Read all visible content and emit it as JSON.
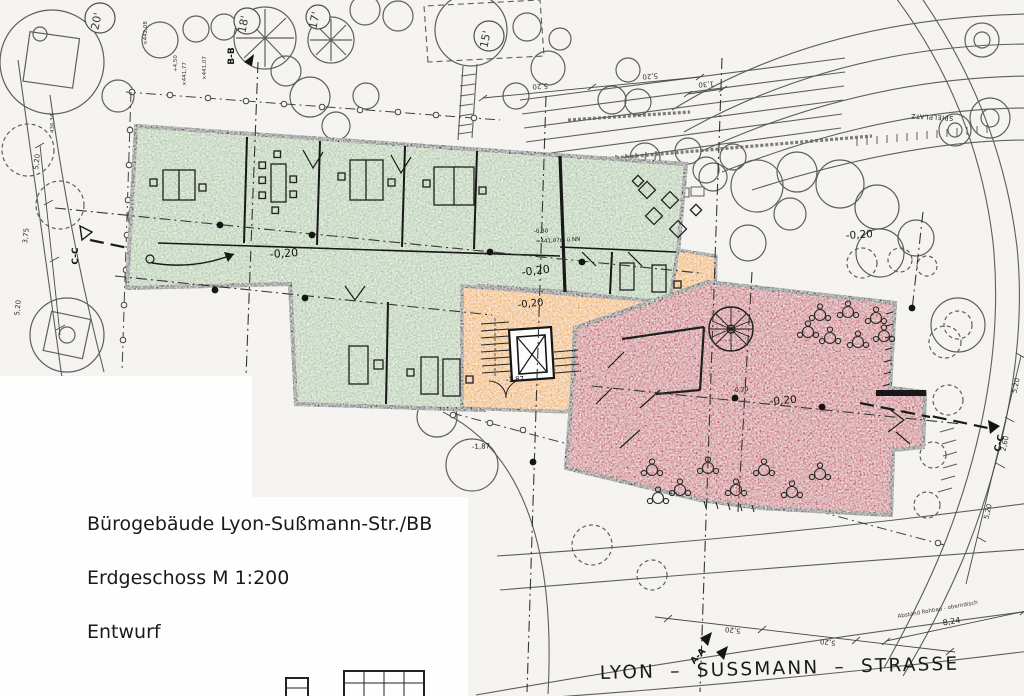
{
  "title_block": {
    "line1": "Bürogebäude Lyon-Sußmann-Str./BB",
    "line2": "Erdgeschoss M 1:200",
    "line3": "Entwurf"
  },
  "street_label": "LYON – SUSSMANN – STRASSE",
  "tree_labels": {
    "t20": "20'",
    "t18": "18'",
    "t17": "17'",
    "t15": "15'"
  },
  "site_labels": {
    "spielplatz": "SPIELPLATZ",
    "abstand_note": "Abstand Rohbau - oberirdisch"
  },
  "section_markers": {
    "bb": "B-B",
    "aa": "A-A",
    "cc_left": "C-C",
    "cc_right": "C-C"
  },
  "levels": {
    "green_left": "-0,20",
    "green_right": "-0,20",
    "green_small": "-0,30",
    "green_elev": "=441,07m ü.NN",
    "yellow": "-0,20",
    "stair": "-1,87",
    "red": "-0,20",
    "red_small": "-0,20",
    "red_outside": "-0,20",
    "site": "-1,87"
  },
  "elevations": {
    "e1": "×442,08",
    "e2": "+4,50",
    "e3": "×441,77",
    "e4": "×441,07",
    "e5": "436,34"
  },
  "dimensions": {
    "d130": "1,30",
    "d520": "5,20",
    "d260": "2,60",
    "d375": "3,75",
    "d824": "8,24"
  },
  "colors": {
    "green": "#a4c49c",
    "yellow": "#f0a70d",
    "red": "#c23c52",
    "wall": "#141414"
  }
}
